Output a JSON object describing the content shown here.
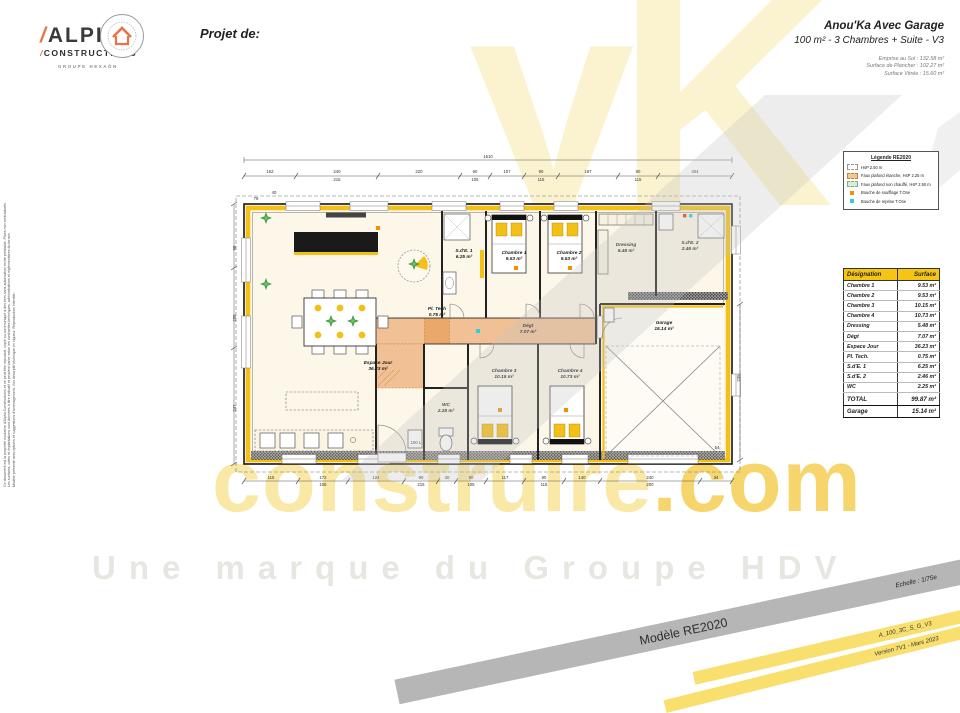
{
  "colors": {
    "accent_yellow": "#F3C018",
    "corridor_orange": "#F1C095",
    "table_header_yellow": "#F6C513",
    "band_gray": "#B6B6B6",
    "band_yellow": "#F8DF6E",
    "supply_dot_orange": "#F29100",
    "return_dot_cyan": "#2AD0DC",
    "logo_orange": "#E8734A"
  },
  "header": {
    "logo": {
      "slash": "/",
      "name": "ALPHA",
      "sub": "CONSTRUCTIONS",
      "group": "GROUPE HEXAÔN"
    },
    "project_label": "Projet de:",
    "title": "Anou'Ka Avec Garage",
    "subtitle": "100 m² - 3 Chambres + Suite - V3",
    "metrics": [
      "Emprise au Sol : 132.58 m²",
      "Surface de Plancher : 102.27 m²",
      "Surface Vitrée : 15.60 m²"
    ]
  },
  "watermark": {
    "big": "yK",
    "brand": "construire",
    "tld": ".com",
    "tagline": "Une marque du Groupe HDV"
  },
  "legend": {
    "title": "Légende RE2020",
    "items": [
      {
        "swatch": "dashed-white",
        "label": "HsP 2.50 m"
      },
      {
        "swatch": "orange",
        "label": "Faux plafond étanche, HsP 2.25 m"
      },
      {
        "swatch": "green",
        "label": "Faux plafond non chauffé, HsP 2.50 m"
      },
      {
        "swatch": "dot-orange",
        "label": "Bouche de soufflage T.One"
      },
      {
        "swatch": "dot-cyan",
        "label": "Bouche de reprise T.One"
      }
    ]
  },
  "surface_table": {
    "headers": [
      "Désignation",
      "Surface"
    ],
    "rows": [
      [
        "Chambre 1",
        "9.53 m²"
      ],
      [
        "Chambre 2",
        "9.53 m²"
      ],
      [
        "Chambre 3",
        "10.15 m²"
      ],
      [
        "Chambre 4",
        "10.73 m²"
      ],
      [
        "Dressing",
        "5.48 m²"
      ],
      [
        "Dégt",
        "7.07 m²"
      ],
      [
        "Espace Jour",
        "36.23 m²"
      ],
      [
        "Pl. Tech.",
        "0.75 m²"
      ],
      [
        "S.d'E. 1",
        "6.25 m²"
      ],
      [
        "S.d'E. 2",
        "2.46 m²"
      ],
      [
        "WC",
        "2.25 m²"
      ]
    ],
    "total": [
      "TOTAL",
      "99.87 m²"
    ],
    "annex": [
      "Garage",
      "15.14 m²"
    ]
  },
  "banners": {
    "gray_left": "Modèle RE2020",
    "gray_right": "Echelle : 1/75e",
    "yellow1": "A_100_3C_S_G_V3",
    "yellow2": "Version 7V1 - Mars 2023"
  },
  "disclaimer": {
    "lines": [
      "Ce document est la propriété exclusive d'Alpha Constructions et ne peut être reproduit, copié ou communiqué à des tiers sans autorisation écrite préalable. Plans non contractuels.",
      "Les surfaces, cotes et implantations sont données à titre indicatif et peuvent varier selon les contraintes techniques, administratives et réglementaires du terrain.",
      "Modèle présenté avec options et suggestions d'aménagement. Voir descriptif technique en vigueur. Reproduction interdite."
    ]
  },
  "plan": {
    "rooms": [
      {
        "name": "Espace Jour",
        "area": "36.23 m²",
        "x": 150,
        "y": 216
      },
      {
        "name": "S.d'E. 1",
        "area": "6.25 m²",
        "x": 236,
        "y": 104,
        "s": 4.2
      },
      {
        "name": "Chambre 1",
        "area": "9.53 m²",
        "x": 286,
        "y": 106
      },
      {
        "name": "Chambre 2",
        "area": "9.53 m²",
        "x": 341,
        "y": 106
      },
      {
        "name": "Dressing",
        "area": "5.48 m²",
        "x": 398,
        "y": 98,
        "s": 4.2
      },
      {
        "name": "S.d'E. 2",
        "area": "2.46 m²",
        "x": 462,
        "y": 96,
        "s": 4.2
      },
      {
        "name": "Dégt",
        "area": "7.07 m²",
        "x": 300,
        "y": 179,
        "s": 4
      },
      {
        "name": "Pl. Tech",
        "area": "0.75 m²",
        "x": 209,
        "y": 162,
        "s": 3.6
      },
      {
        "name": "WC",
        "area": "2.25 m²",
        "x": 218,
        "y": 258,
        "s": 3.8
      },
      {
        "name": "Chambre 3",
        "area": "10.15 m²",
        "x": 276,
        "y": 224
      },
      {
        "name": "Chambre 4",
        "area": "10.73 m²",
        "x": 342,
        "y": 224
      },
      {
        "name": "Garage",
        "area": "15.14 m²",
        "x": 436,
        "y": 176
      }
    ],
    "dims": [
      {
        "t": "1610",
        "x": 260,
        "y": 10
      },
      {
        "t": "162",
        "x": 42,
        "y": 25
      },
      {
        "t": "240",
        "x": 109,
        "y": 25
      },
      {
        "t": "215",
        "x": 109,
        "y": 33,
        "s": 3.8
      },
      {
        "t": "220",
        "x": 191,
        "y": 25
      },
      {
        "t": "60",
        "x": 247,
        "y": 25
      },
      {
        "t": "105",
        "x": 247,
        "y": 33,
        "s": 3.8
      },
      {
        "t": "107",
        "x": 279,
        "y": 25
      },
      {
        "t": "90",
        "x": 313,
        "y": 25
      },
      {
        "t": "115",
        "x": 313,
        "y": 33,
        "s": 3.8
      },
      {
        "t": "197",
        "x": 360,
        "y": 25
      },
      {
        "t": "90",
        "x": 410,
        "y": 25
      },
      {
        "t": "115",
        "x": 410,
        "y": 33,
        "s": 3.8
      },
      {
        "t": "404",
        "x": 467,
        "y": 25
      },
      {
        "t": "115",
        "x": 43,
        "y": 331
      },
      {
        "t": "172",
        "x": 95,
        "y": 331
      },
      {
        "t": "105",
        "x": 95,
        "y": 338,
        "s": 3.8
      },
      {
        "t": "124",
        "x": 148,
        "y": 331
      },
      {
        "t": "90",
        "x": 193,
        "y": 331
      },
      {
        "t": "215",
        "x": 193,
        "y": 338,
        "s": 3.8
      },
      {
        "t": "30",
        "x": 219,
        "y": 331
      },
      {
        "t": "90",
        "x": 243,
        "y": 331
      },
      {
        "t": "105",
        "x": 243,
        "y": 338,
        "s": 3.8
      },
      {
        "t": "117",
        "x": 277,
        "y": 331
      },
      {
        "t": "90",
        "x": 316,
        "y": 331
      },
      {
        "t": "115",
        "x": 316,
        "y": 338,
        "s": 3.8
      },
      {
        "t": "140",
        "x": 354,
        "y": 331
      },
      {
        "t": "240",
        "x": 422,
        "y": 331
      },
      {
        "t": "200",
        "x": 422,
        "y": 338,
        "s": 3.8
      },
      {
        "t": "34",
        "x": 488,
        "y": 331
      },
      {
        "t": "98",
        "x": 8,
        "y": 100,
        "r": -90
      },
      {
        "t": "258",
        "x": 8,
        "y": 170,
        "r": -90
      },
      {
        "t": "247",
        "x": 8,
        "y": 260,
        "r": -90
      },
      {
        "t": "235",
        "x": 512,
        "y": 230,
        "r": -90
      },
      {
        "t": "54",
        "x": 489,
        "y": 301,
        "s": 3.8
      },
      {
        "t": "78",
        "x": 28,
        "y": 52,
        "s": 3.5
      },
      {
        "t": "40",
        "x": 46,
        "y": 46,
        "s": 3.5
      },
      {
        "t": "100 L",
        "x": 188,
        "y": 296,
        "s": 3.4
      }
    ]
  }
}
